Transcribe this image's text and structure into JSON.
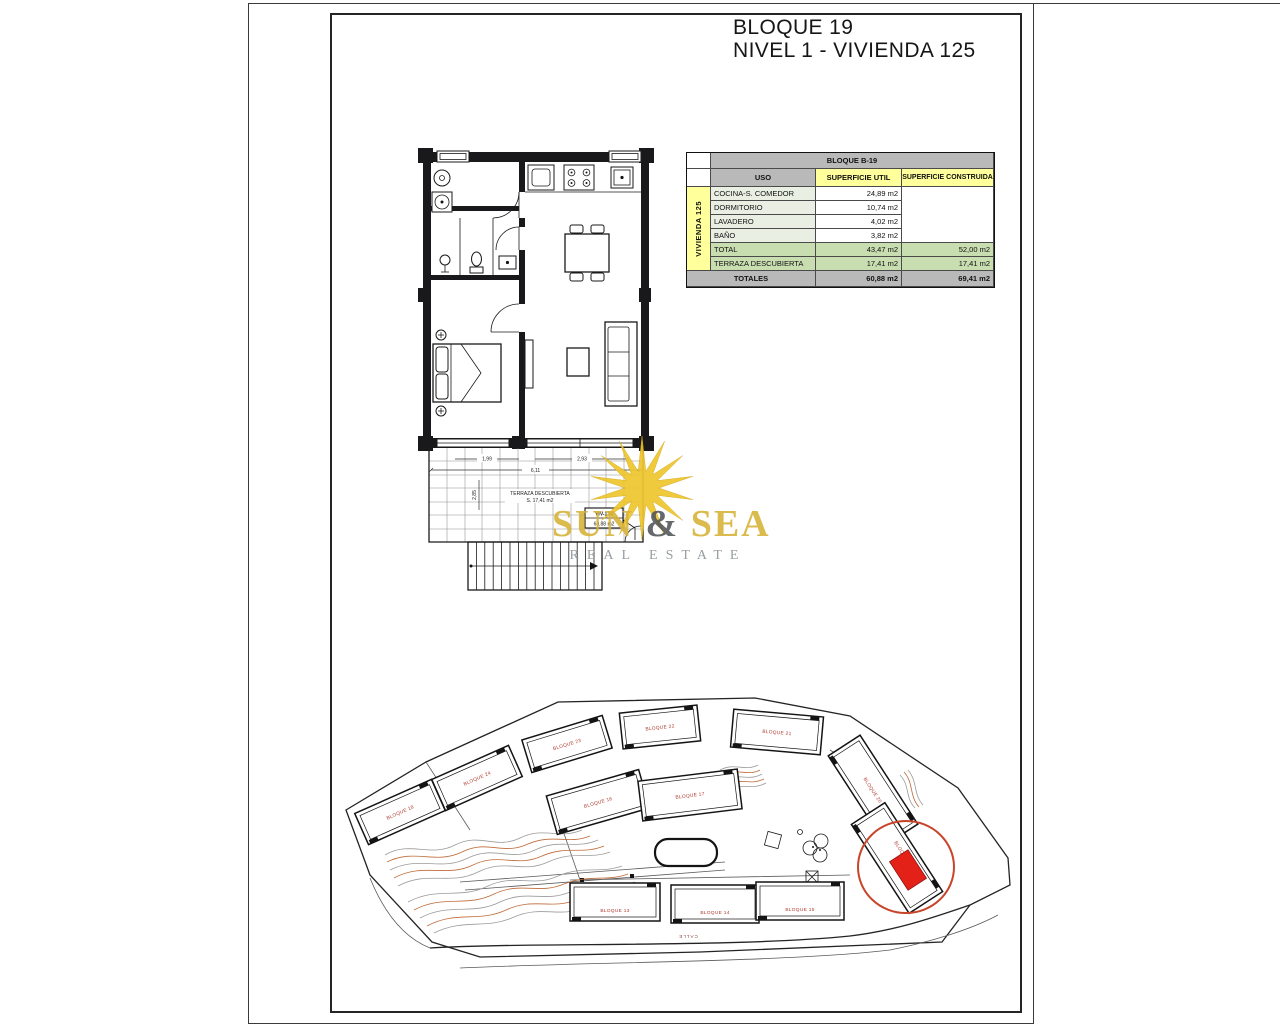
{
  "header": {
    "title_line1": "BLOQUE 19",
    "title_line2": "NIVEL 1 - VIVIENDA 125"
  },
  "area_table": {
    "block_header": "BLOQUE B-19",
    "group_label": "VIVIENDA 125",
    "col_uso": "USO",
    "col_util": "SUPERFICIE UTIL",
    "col_construida": "SUPERFICIE CONSTRUIDA",
    "rows": [
      {
        "uso": "COCINA-S. COMEDOR",
        "util": "24,89 m2",
        "construida": ""
      },
      {
        "uso": "DORMITORIO",
        "util": "10,74 m2",
        "construida": ""
      },
      {
        "uso": "LAVADERO",
        "util": "4,02 m2",
        "construida": ""
      },
      {
        "uso": "BAÑO",
        "util": "3,82 m2",
        "construida": ""
      },
      {
        "uso": "TOTAL",
        "util": "43,47 m2",
        "construida": "52,00 m2"
      },
      {
        "uso": "TERRAZA DESCUBIERTA",
        "util": "17,41 m2",
        "construida": "17,41 m2"
      }
    ],
    "totales_label": "TOTALES",
    "totales_util": "60,88 m2",
    "totales_construida": "69,41 m2"
  },
  "floor_plan": {
    "terrace_label": "TERRAZA DESCUBIERTA",
    "terrace_area": "S. 17,41 m2",
    "dim_width_total": "6,11",
    "dim_width_left": "1,99",
    "dim_width_right": "2,93",
    "dim_depth": "2,85",
    "unit_tag_line1": "VIV-125",
    "unit_tag_line2": "60,88 m2"
  },
  "watermark": {
    "word1": "SUN",
    "amp": "&",
    "word2": "SEA",
    "tagline": "REAL ESTATE"
  },
  "site_plan": {
    "street_label": "CALLE",
    "building_labels": [
      "BLOQUE 18",
      "BLOQUE 24",
      "BLOQUE 23",
      "BLOQUE 22",
      "BLOQUE 21",
      "BLOQUE 16",
      "BLOQUE 17",
      "BLOQUE 20",
      "BLOQUE 19",
      "BLOQUE 13",
      "BLOQUE 14",
      "BLOQUE 15"
    ]
  },
  "colors": {
    "table_grey": "#b9b9b9",
    "table_yellow": "#ffff9b",
    "table_green": "#c8ddb0",
    "table_pale_green": "#e9efe3",
    "brand_gold": "#d6b235",
    "tagline_grey": "#8c9296",
    "highlight_red": "#e32119",
    "building_label_red": "#b03a2e",
    "contour_orange": "#c06a38"
  }
}
